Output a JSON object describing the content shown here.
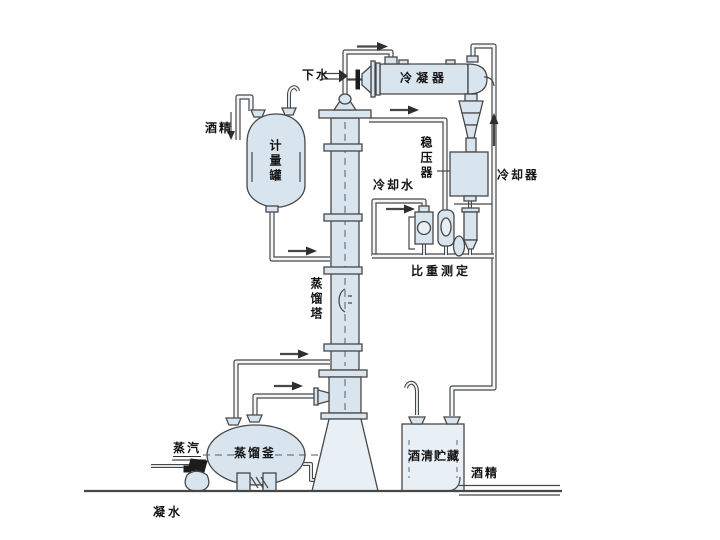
{
  "diagram_type": "alcohol-distillation-process-flow",
  "labels": {
    "down_water": "下水",
    "condenser": "冷凝器",
    "alcohol_in": "酒精",
    "measuring_tank": "计量罐",
    "pressure_stabilizer": "稳压器",
    "cooler": "冷却器",
    "cooling_water": "冷却水",
    "gravity_measurement": "比重测定",
    "distillation_tower": "蒸馏塔",
    "distillation_kettle": "蒸馏釜",
    "steam": "蒸汽",
    "alcohol_storage": "酒清贮藏",
    "alcohol_out": "酒精",
    "condensate_water": "凝水"
  },
  "colors": {
    "line": "#474747",
    "vessel_fill": "#d9e5ee",
    "pipe_inner": "#f3f7fa",
    "background": "#ffffff",
    "text": "#141414"
  }
}
